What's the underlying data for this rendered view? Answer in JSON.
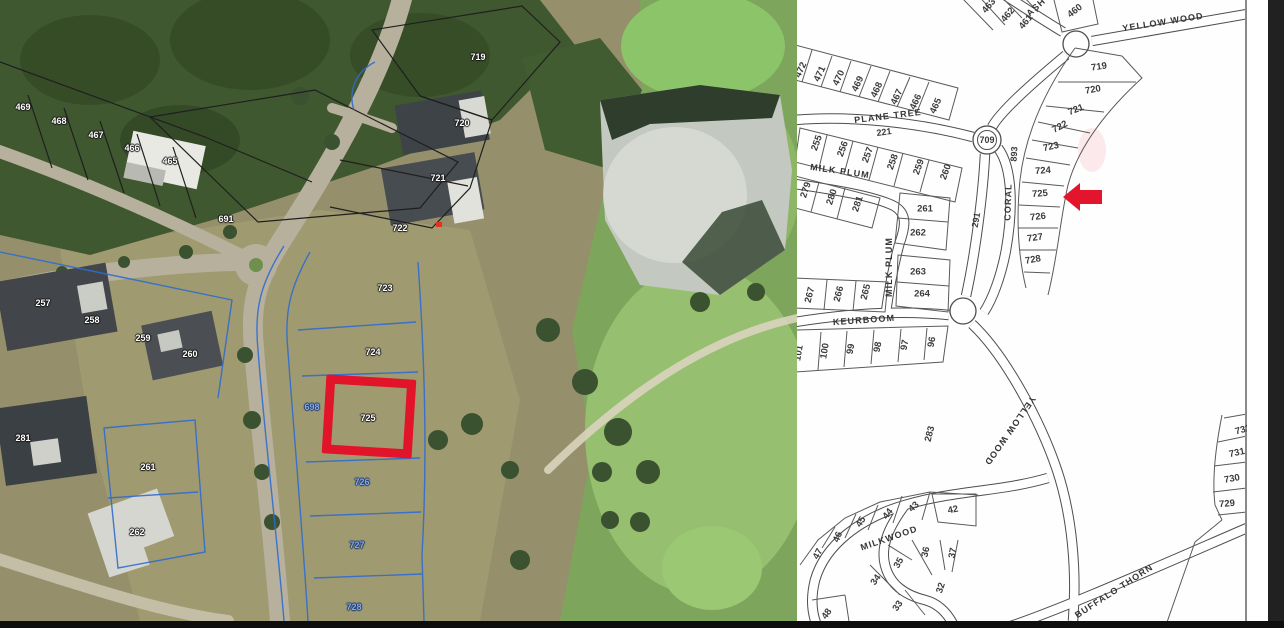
{
  "figure": {
    "type": "property dual map",
    "highlight": {
      "plot": "725",
      "satellite_marker": "red rectangle outline",
      "plan_marker": "red left-pointing arrow"
    },
    "colors": {
      "highlight_red": "#e2142a",
      "blue_label": "#86a9e6",
      "plan_line": "#555555",
      "plan_background": "#ffffff"
    }
  },
  "satellite_map": {
    "white_plot_labels": [
      "469",
      "468",
      "467",
      "466",
      "465",
      "691",
      "719",
      "720",
      "721",
      "722",
      "723",
      "724",
      "725",
      "257",
      "258",
      "259",
      "260",
      "281",
      "261",
      "262"
    ],
    "blue_plot_labels": [
      "698",
      "726",
      "727",
      "728"
    ]
  },
  "plan_map": {
    "street_labels": [
      "YELLOW WOOD",
      "ASH",
      "PLANE TREE",
      "MILK PLUM",
      "MILK PLUM",
      "KEURBOOM",
      "CORAL",
      "YELLOW WOOD",
      "MILKWOOD",
      "BUFFALO THORN"
    ],
    "road_numbers": [
      "709",
      "221",
      "893",
      "291"
    ],
    "plot_labels": [
      "463",
      "462",
      "461",
      "460",
      "472",
      "471",
      "470",
      "469",
      "468",
      "467",
      "466",
      "465",
      "255",
      "256",
      "257",
      "258",
      "259",
      "260",
      "279",
      "280",
      "281",
      "261",
      "262",
      "263",
      "264",
      "267",
      "266",
      "265",
      "101",
      "100",
      "99",
      "98",
      "97",
      "96",
      "283",
      "719",
      "720",
      "721",
      "722",
      "723",
      "724",
      "725",
      "726",
      "727",
      "728",
      "42",
      "43",
      "44",
      "45",
      "46",
      "47",
      "37",
      "36",
      "35",
      "34",
      "32",
      "33",
      "48",
      "732",
      "731",
      "730",
      "729"
    ]
  }
}
